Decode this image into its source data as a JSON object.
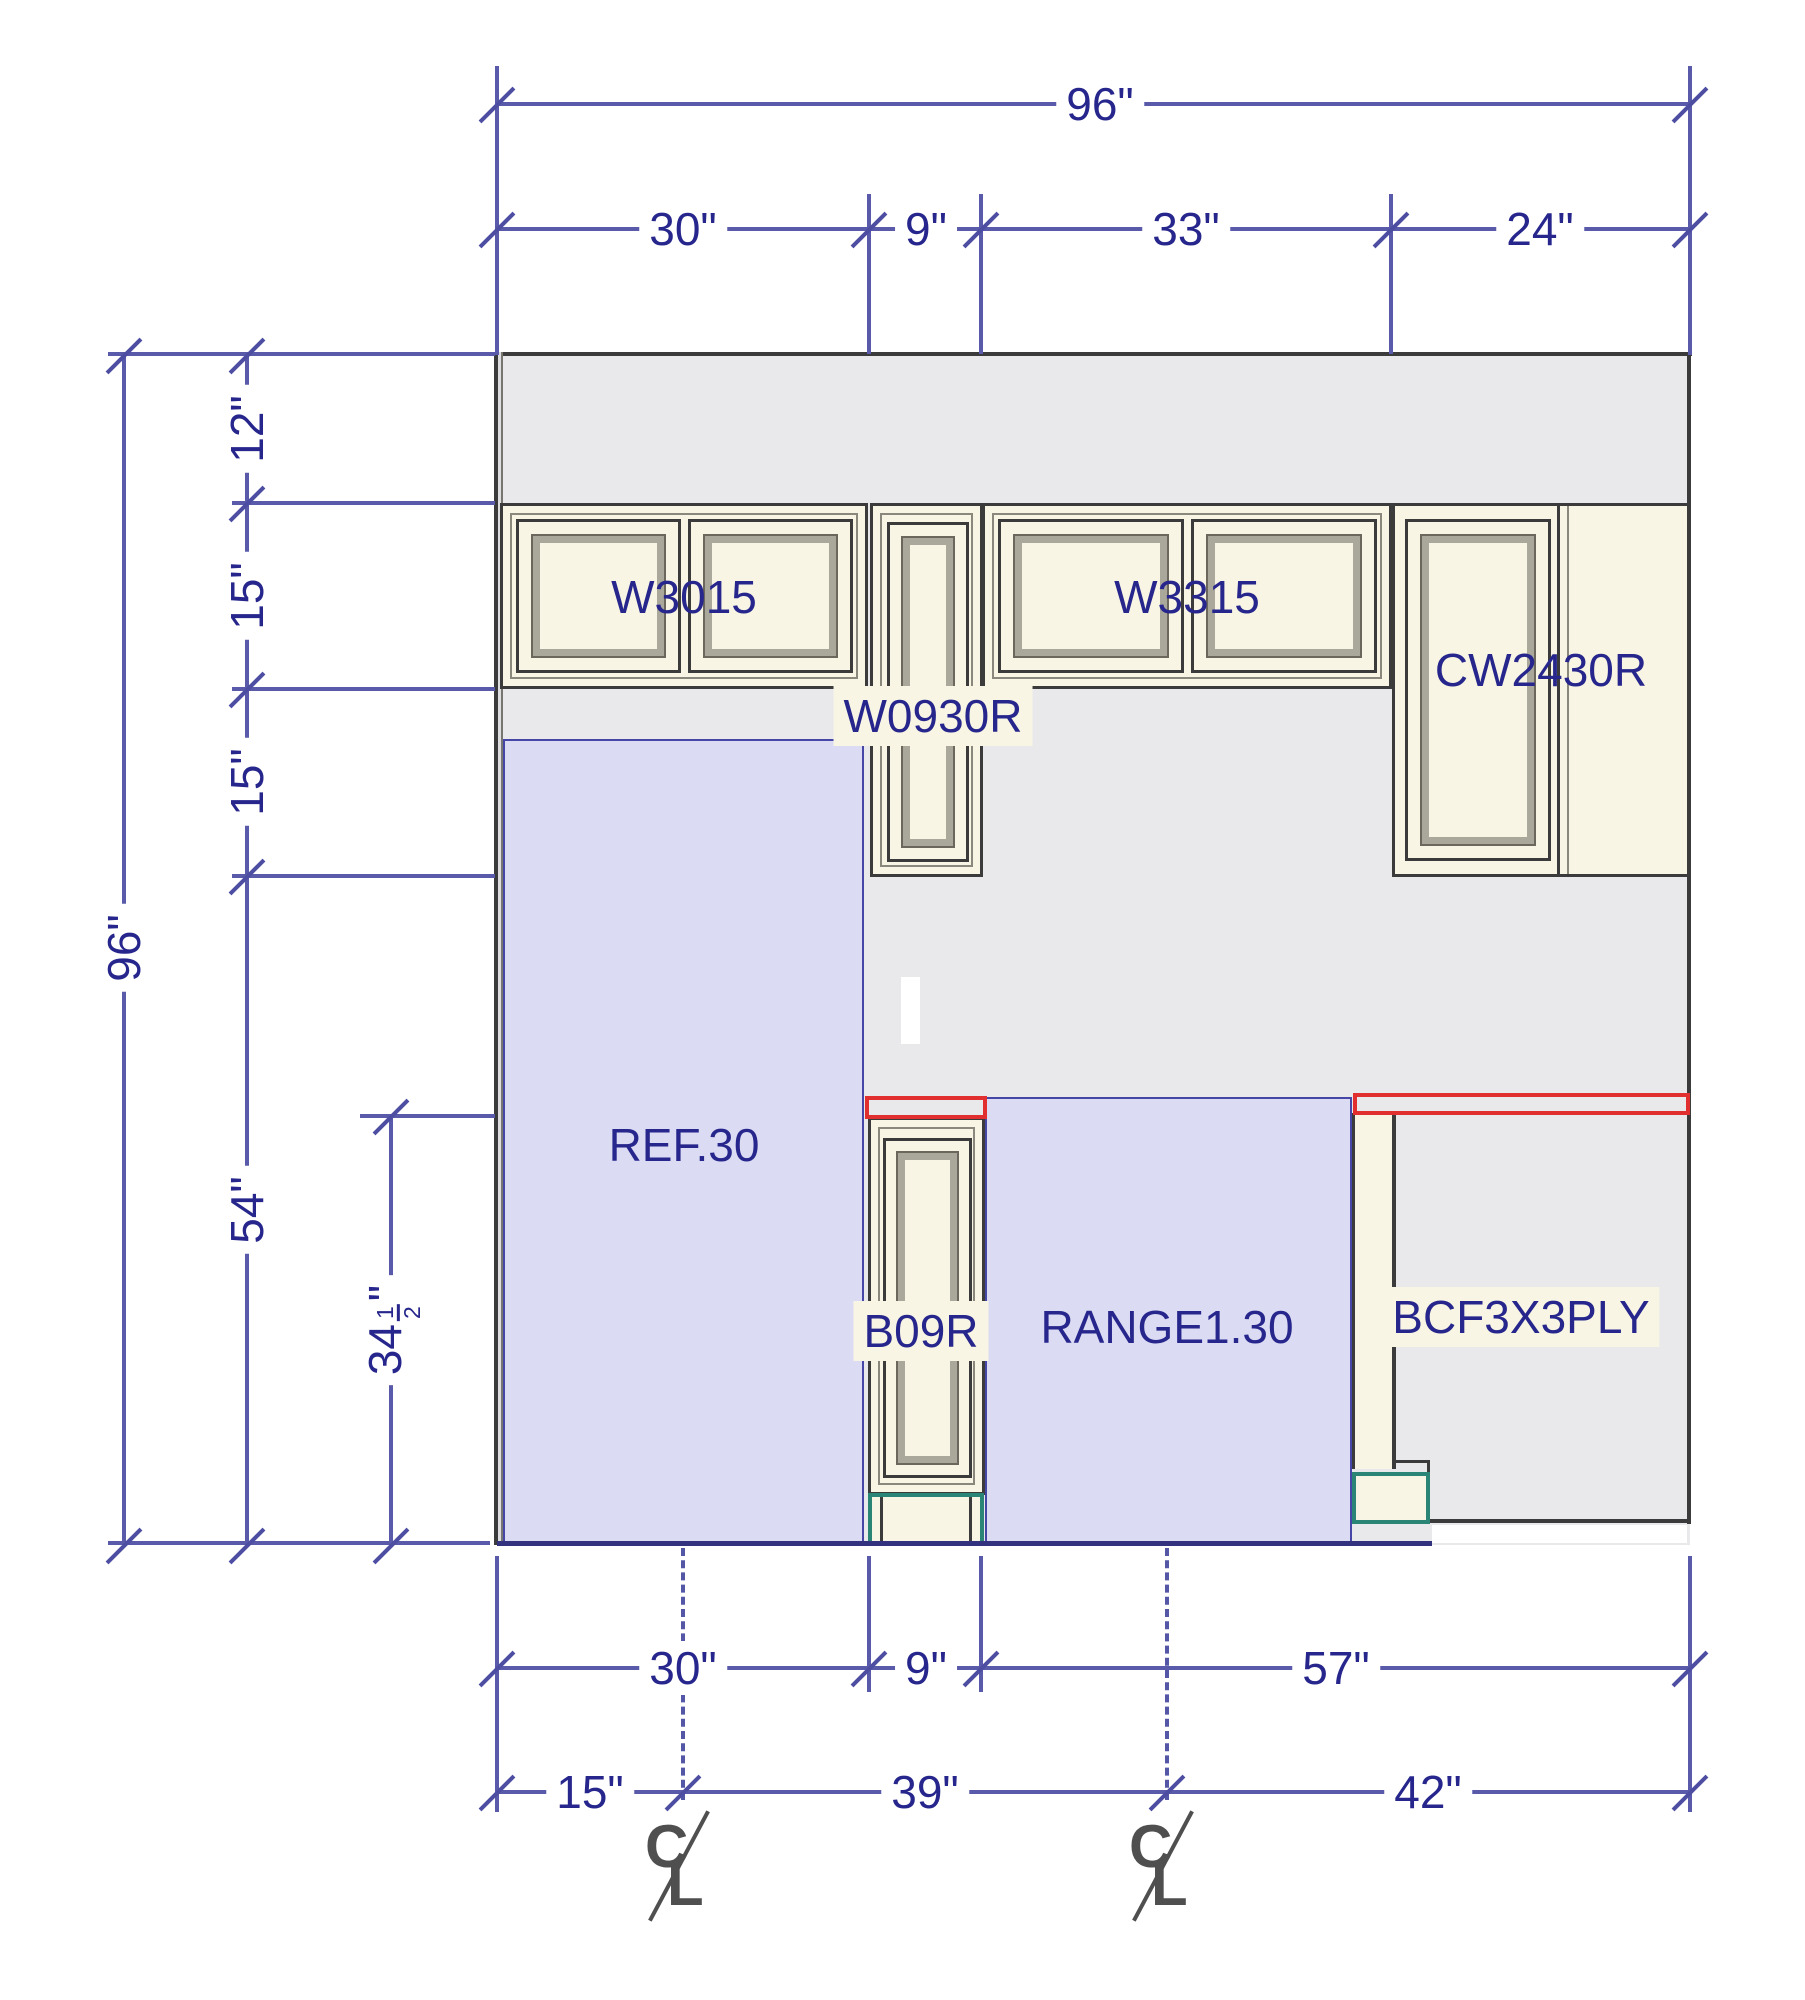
{
  "drawing": {
    "wall_width_label": "96\"",
    "wall_height_label": "96\"",
    "top_segments": [
      "30\"",
      "9\"",
      "33\"",
      "24\""
    ],
    "left_segments": [
      "12\"",
      "15\"",
      "15\"",
      "54\""
    ],
    "counter_height": {
      "whole": "34",
      "numerator": "1",
      "denominator": "2",
      "unit": "\""
    },
    "bottom_row1": [
      "30\"",
      "9\"",
      "57\""
    ],
    "bottom_row2": [
      "15\"",
      "39\"",
      "42\""
    ],
    "centerline": {
      "c": "C",
      "l": "L"
    }
  },
  "cabinets": {
    "w3015": "W3015",
    "w3315": "W3315",
    "w0930r": "W0930R",
    "cw2430r": "CW2430R",
    "ref": "REF.30",
    "b09r": "B09R",
    "range": "RANGE1.30",
    "bcf": "BCF3X3PLY"
  },
  "colors": {
    "dim_text_blue": "#26268c",
    "dim_line_blue": "#5a5aaa",
    "wall_gray": "#e9e9eb",
    "cabinet_ivory": "#f8f5e4",
    "region_lavender": "#dbdbf3",
    "counter_red": "#e12f2f",
    "toe_kick_teal": "#2a8577",
    "outline_dark": "#3b3b3b"
  }
}
